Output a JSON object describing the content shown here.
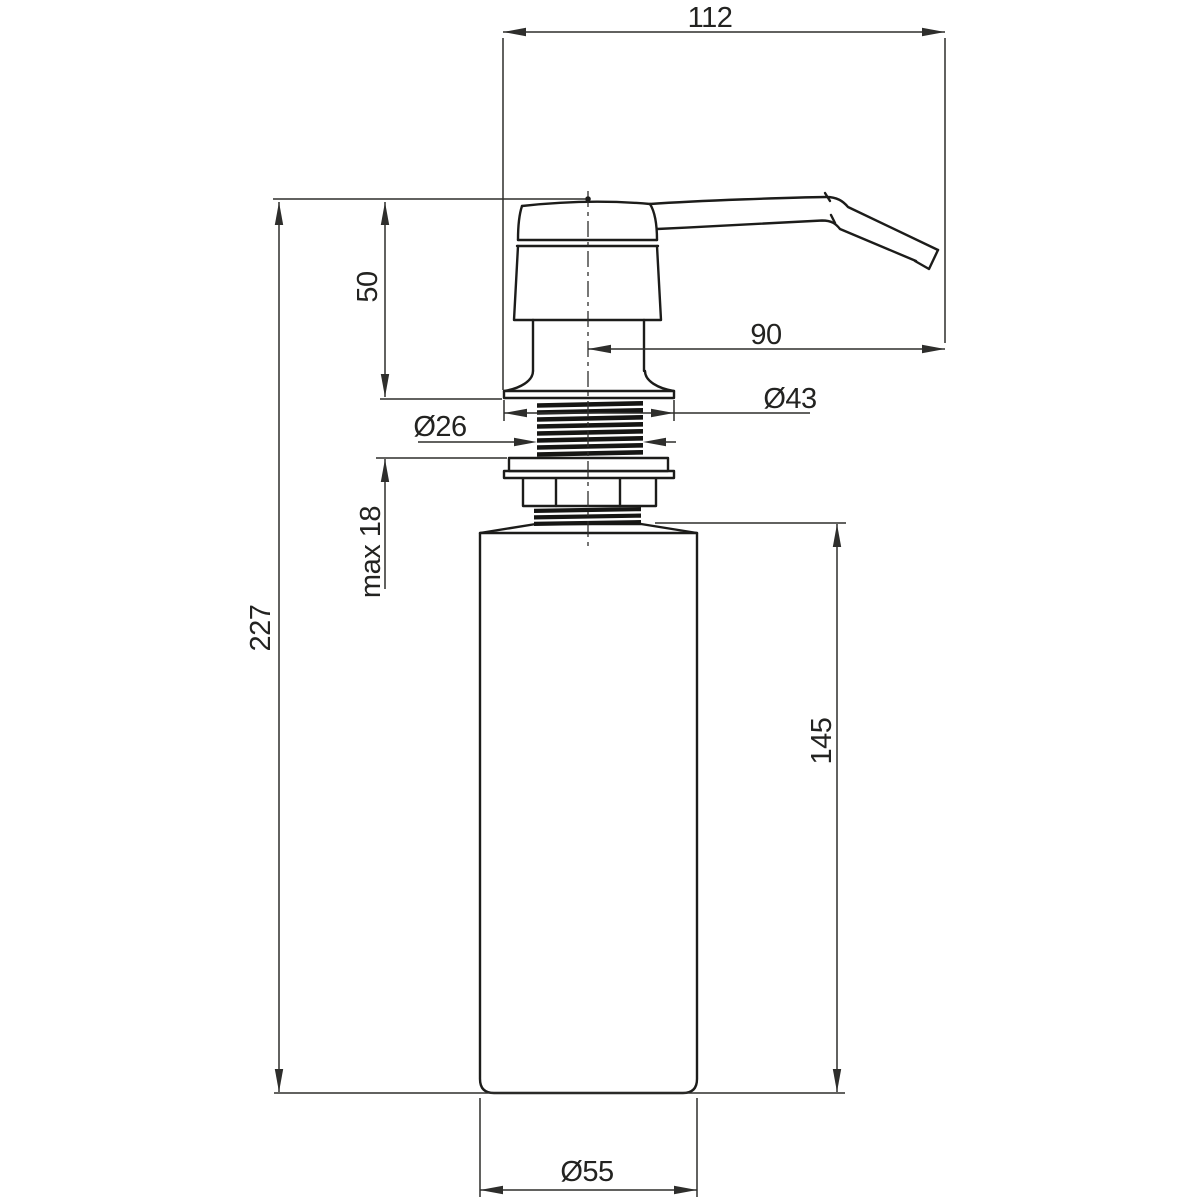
{
  "drawing": {
    "type": "technical-dimension-drawing",
    "subject": "built-in kitchen soap dispenser, side elevation with millimetre dimensions",
    "background": "#ffffff",
    "object_line_color": "#1c1c1a",
    "dimension_line_color": "#2e2e2c",
    "dimensions": {
      "overall_width": {
        "label": "112"
      },
      "spout_reach": {
        "label": "90"
      },
      "head_height": {
        "label": "50"
      },
      "flange_diameter": {
        "label": "Ø43"
      },
      "thread_diameter": {
        "label": "Ø26"
      },
      "max_counter_thickness": {
        "label": "max 18"
      },
      "total_height": {
        "label": "227"
      },
      "bottle_height": {
        "label": "145"
      },
      "bottle_diameter": {
        "label": "Ø55"
      }
    }
  }
}
